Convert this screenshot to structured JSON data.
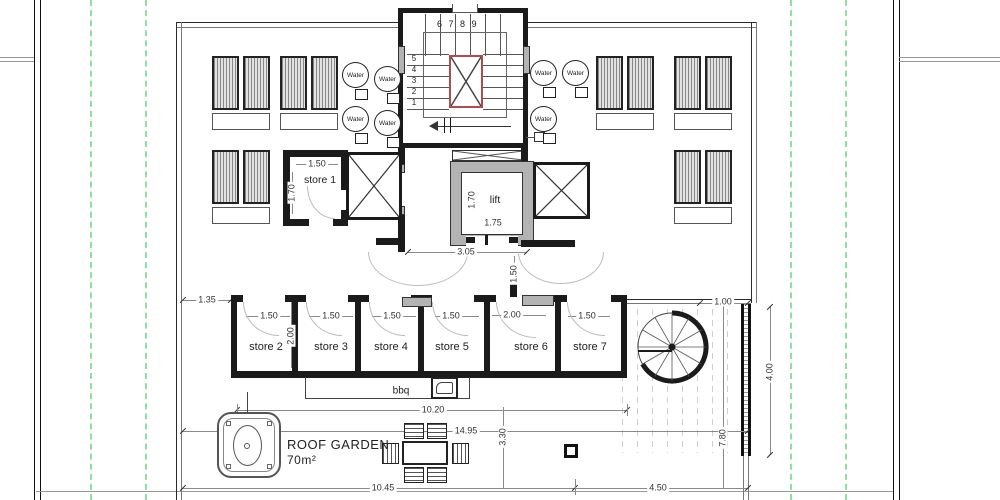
{
  "plan": {
    "water_label": "Water",
    "rooms": {
      "store1": "store 1",
      "store2": "store 2",
      "store3": "store 3",
      "store4": "store 4",
      "store5": "store 5",
      "store6": "store 6",
      "store7": "store 7",
      "lift": "lift",
      "bbq": "bbq",
      "roof_garden": "ROOF GARDEN",
      "roof_garden_area": "70m²"
    },
    "stair": {
      "upper_flight_numbers": "6 7 8 9",
      "lower_flight_numbers": [
        "5",
        "4",
        "3",
        "2",
        "1"
      ]
    },
    "dims": {
      "store1_width": "1.50",
      "store1_depth": "1.70",
      "lift_depth": "1.70",
      "lift_width": "1.75",
      "lobby_width": "3.05",
      "lobby_depth": "1.50",
      "left_offset": "1.35",
      "store2_door": "1.50",
      "store2_depth": "2.00",
      "store3_door": "1.50",
      "store4_door": "1.50",
      "store5_door": "1.50",
      "store6_door": "2.00",
      "store7_door": "1.50",
      "terrace_offset": "1.00",
      "terrace_width": "4.00",
      "stores_length": "10.20",
      "overall_length": "14.95",
      "garden_depth": "3.30",
      "terrace_depth": "7.80",
      "bottom_left_length": "10.45",
      "bottom_right_length": "4.50"
    },
    "colors": {
      "boundary_dashed": "#8fdfa5",
      "stair_void_red": "#b04c4c",
      "wall": "#1b1b1b",
      "wall_fill": "#b3b3b3"
    }
  }
}
